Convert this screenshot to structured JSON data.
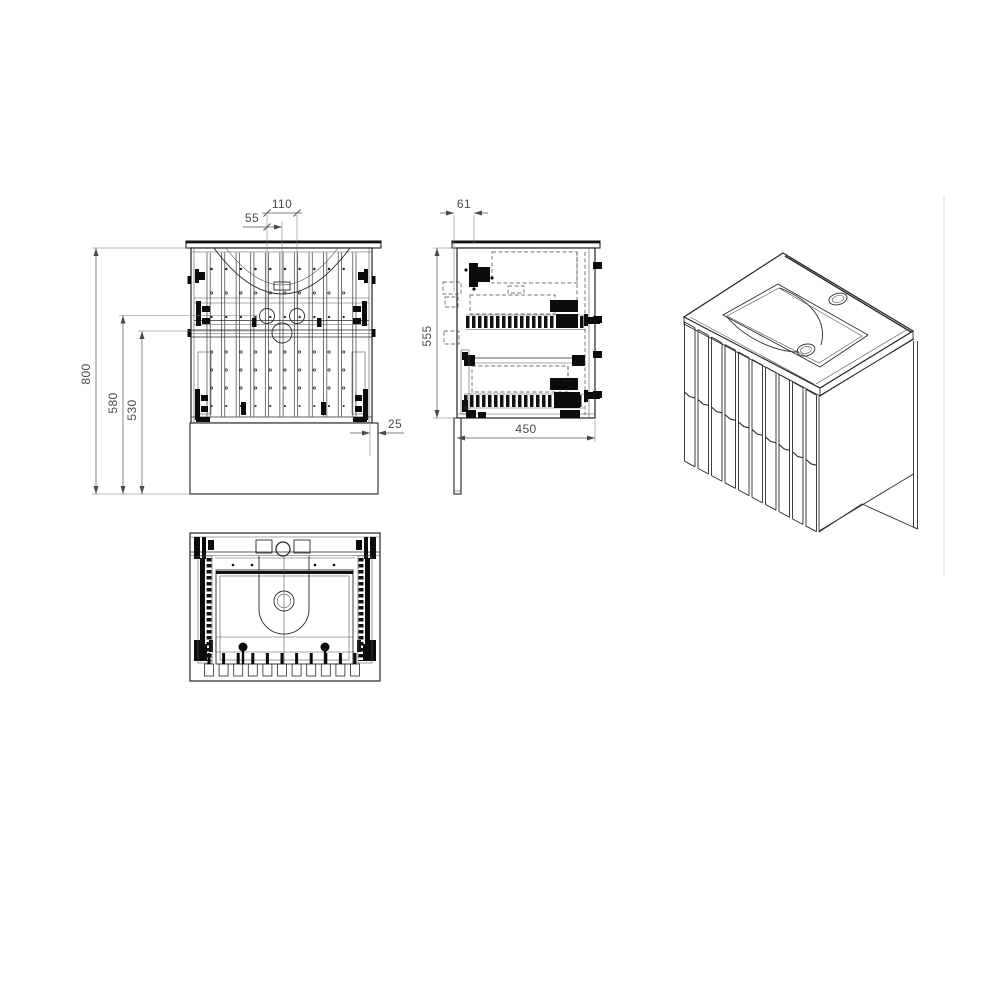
{
  "drawing": {
    "title": "Vanity unit technical drawing",
    "subject": "wall vanity with basin, fluted slat front and two drawers",
    "units": "mm",
    "colors": {
      "line": "#2a2a2a",
      "dimension": "#4a4a4a",
      "background": "#ffffff"
    },
    "views": {
      "front": {
        "label": "front-view"
      },
      "side": {
        "label": "side-view"
      },
      "top": {
        "label": "top-plan-view"
      },
      "iso": {
        "label": "isometric-view"
      }
    },
    "dims": {
      "front": {
        "hole_spacing": "110",
        "hole_half_spacing": "55",
        "overall_height": "800",
        "inner_height_1": "580",
        "inner_height_2": "530",
        "edge_offset": "25"
      },
      "side": {
        "front_inset": "61",
        "carcass_height": "555",
        "depth": "450"
      }
    }
  }
}
